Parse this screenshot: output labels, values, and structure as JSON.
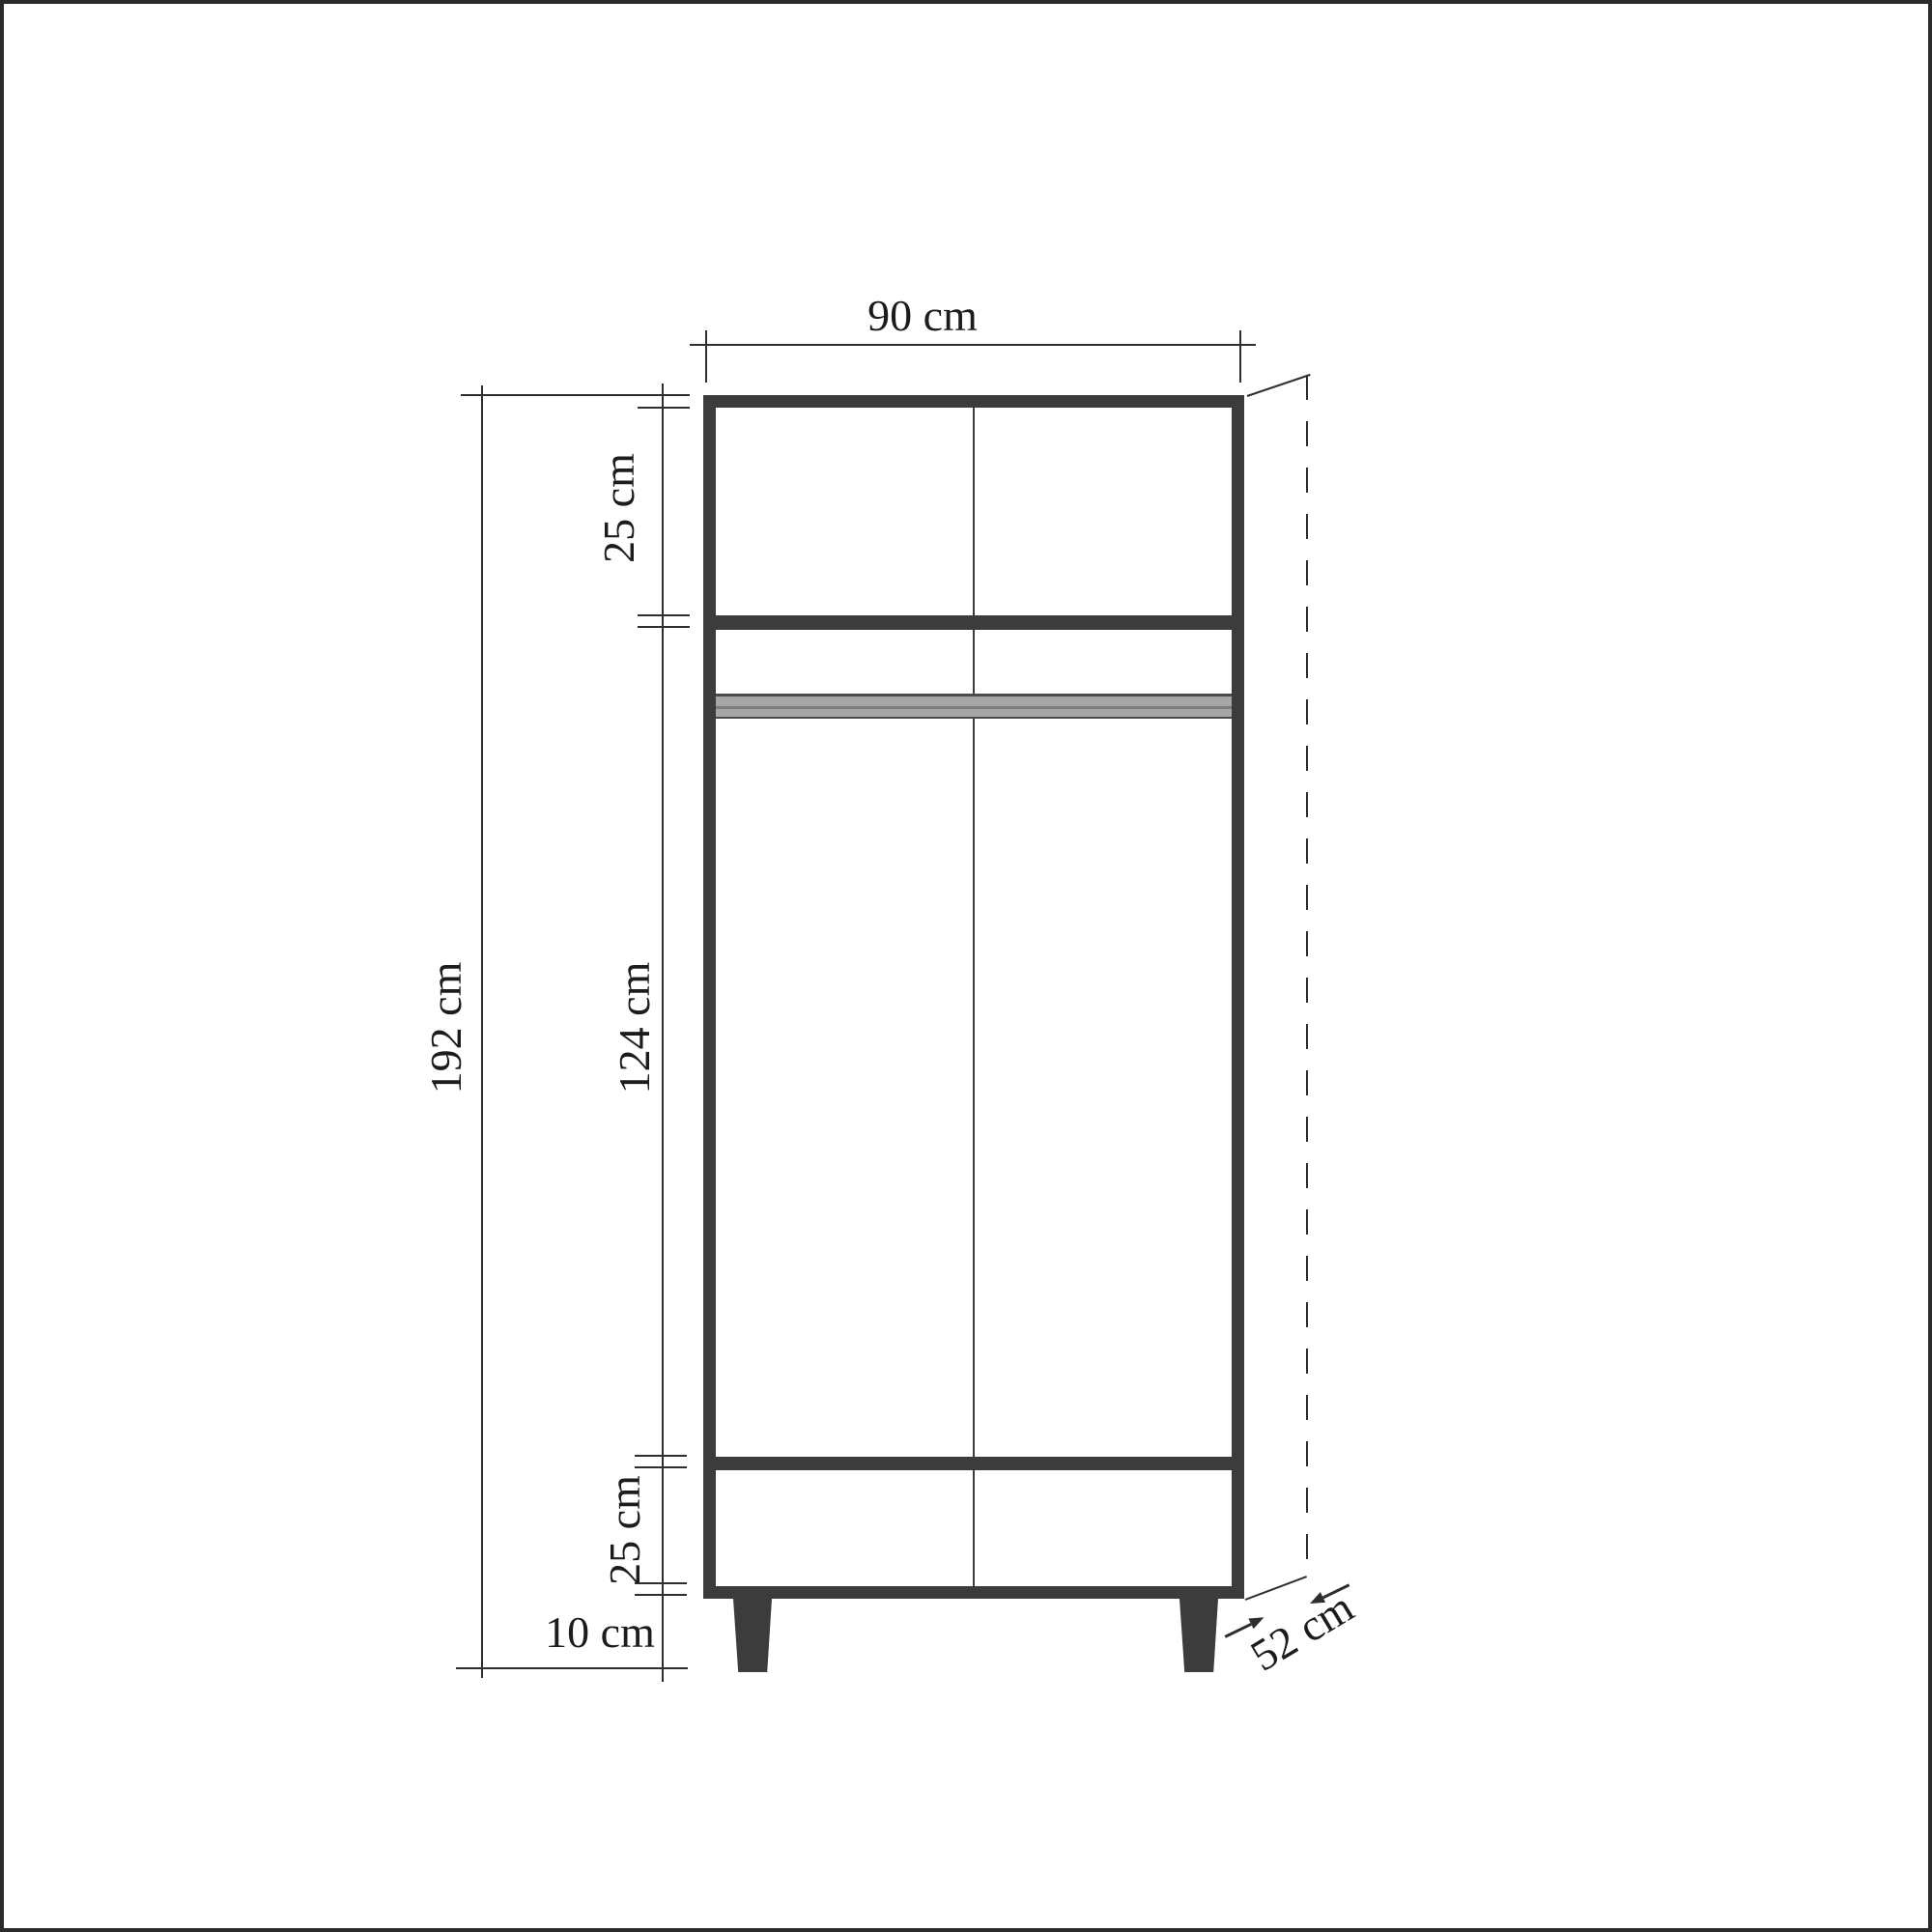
{
  "diagram": {
    "type": "furniture-dimension-drawing",
    "subject": "two-door wardrobe front elevation with depth projection",
    "units": "cm",
    "labels": {
      "overall_width": "90 cm",
      "overall_height": "192 cm",
      "top_section_height": "25 cm",
      "middle_section_height": "124 cm",
      "bottom_section_height": "25 cm",
      "leg_height": "10 cm",
      "depth": "52 cm"
    },
    "colors": {
      "cabinet_outline": "#3c3c3c",
      "dimension_line": "#2e2e2e",
      "hanger_rail_gray": "#a6a6a6",
      "hanger_rail_edge": "#4a4a4a",
      "background": "#ffffff",
      "frame_border": "#2a2a2a"
    }
  }
}
